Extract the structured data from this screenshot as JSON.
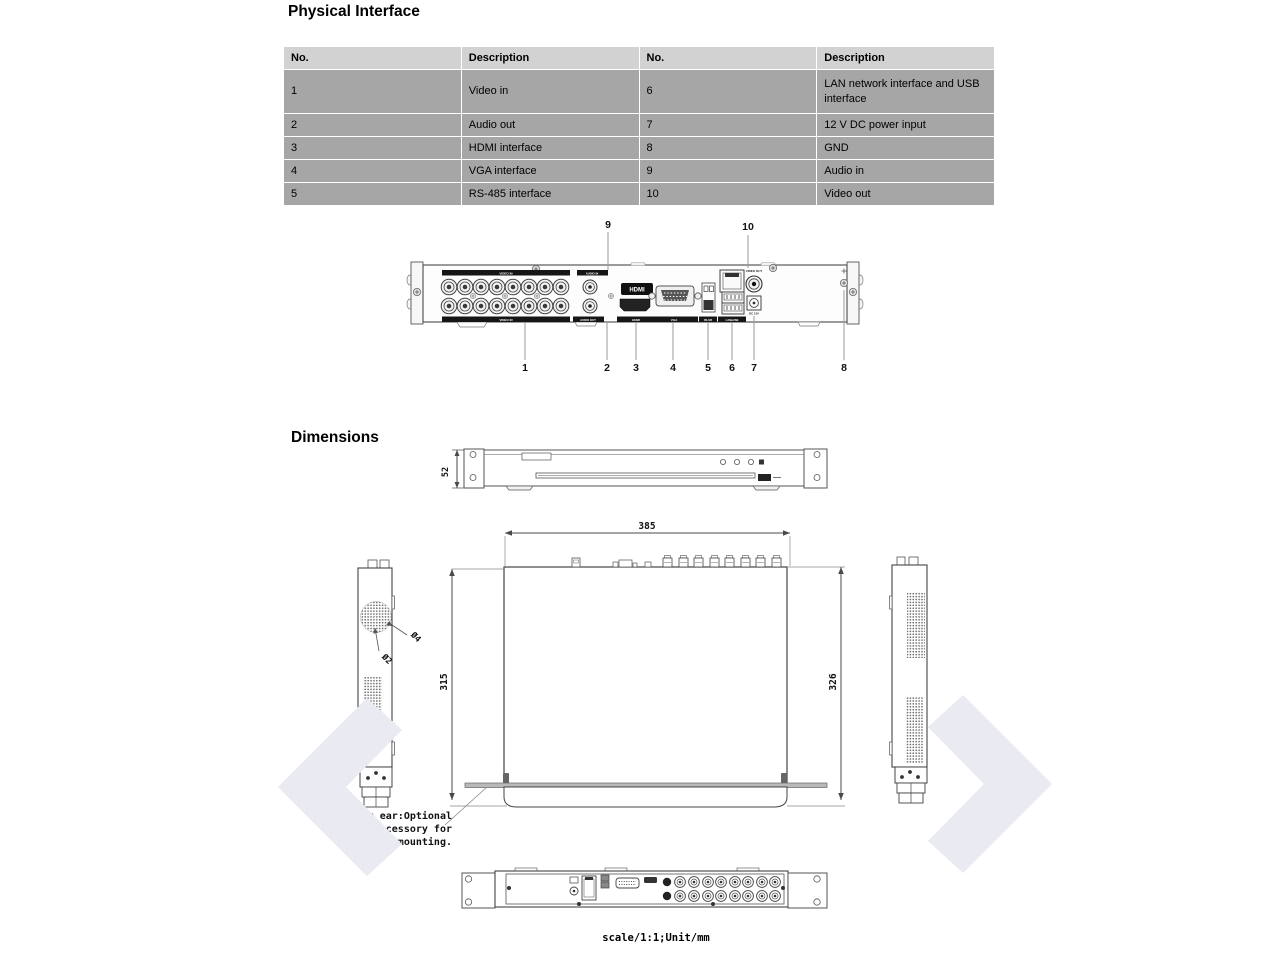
{
  "physical_interface": {
    "title": "Physical Interface",
    "table": {
      "headers": [
        "No.",
        "Description",
        "No.",
        "Description"
      ],
      "rows": [
        [
          "1",
          "Video in",
          "6",
          "LAN network interface and USB interface"
        ],
        [
          "2",
          "Audio out",
          "7",
          "12 V DC power input"
        ],
        [
          "3",
          "HDMI interface",
          "8",
          "GND"
        ],
        [
          "4",
          "VGA interface",
          "9",
          "Audio in"
        ],
        [
          "5",
          "RS-485 interface",
          "10",
          "Video out"
        ]
      ]
    },
    "callouts": {
      "top": [
        "9",
        "10"
      ],
      "bottom": [
        "1",
        "2",
        "3",
        "4",
        "5",
        "6",
        "7",
        "8"
      ]
    },
    "port_labels": {
      "video_in_top": "VIDEO IN",
      "video_in_bottom": "VIDEO IN",
      "audio_in": "AUDIO IN",
      "audio_out": "AUDIO OUT",
      "hdmi_badge": "HDMI",
      "hdmi": "HDMI",
      "vga": "VGA",
      "rs485": "RS-485",
      "lan_usb": "LAN&USB",
      "video_out": "VIDEO OUT",
      "dc": "DC 12V"
    }
  },
  "dimensions": {
    "title": "Dimensions",
    "height": "52",
    "width": "385",
    "depth_body": "315",
    "depth_total": "326",
    "hole_small": "Ø2",
    "hole_large": "Ø4",
    "note_lines": [
      "Mounting ear:Optional",
      "accessory for",
      "rack-mounting."
    ],
    "scale_note": "scale/1:1;Unit/mm"
  },
  "colors": {
    "table_header_bg": "#d2d2d2",
    "table_row_bg": "#a6a6a6",
    "line": "#4a4a4a",
    "watermark": "#e9eaf2"
  }
}
